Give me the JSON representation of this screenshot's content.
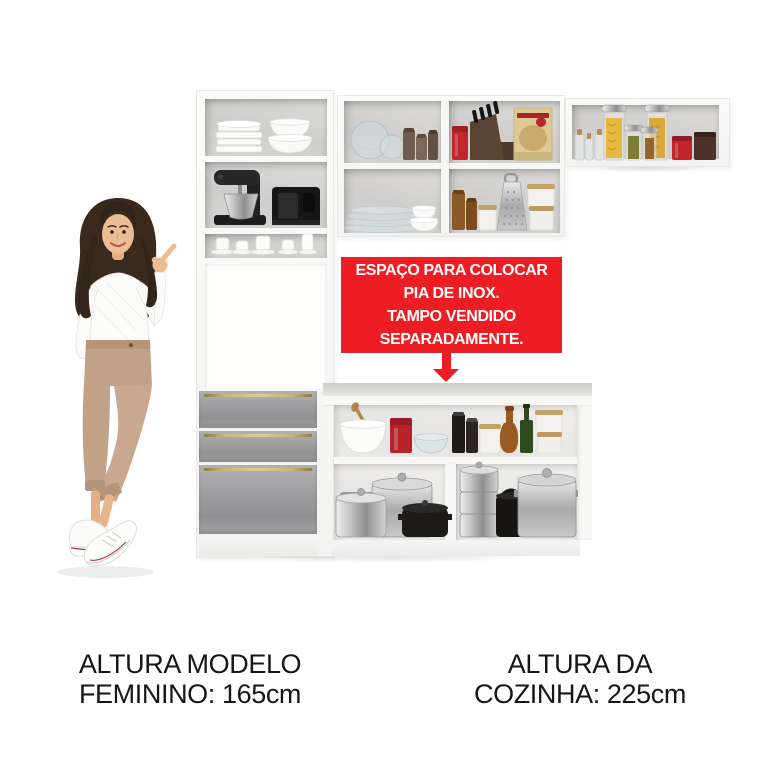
{
  "annotation": {
    "line1": "ESPAÇO PARA COLOCAR",
    "line2": "PIA DE INOX.",
    "line3": "TAMPO VENDIDO",
    "line4": "SEPARADAMENTE.",
    "bg_color": "#ee1c23",
    "text_color": "#ffffff"
  },
  "captions": {
    "model": {
      "line1": "ALTURA MODELO",
      "line2": "FEMININO: 165cm"
    },
    "kitchen": {
      "line1": "ALTURA DA",
      "line2": "COZINHA: 225cm"
    }
  },
  "colors": {
    "background": "#ffffff",
    "cabinet_white": "#f6f6f4",
    "drawer_gray": "#9b9b9d",
    "handle_gold": "#b9a66e",
    "annotation_red": "#ee1c23",
    "caption_text": "#161616"
  }
}
